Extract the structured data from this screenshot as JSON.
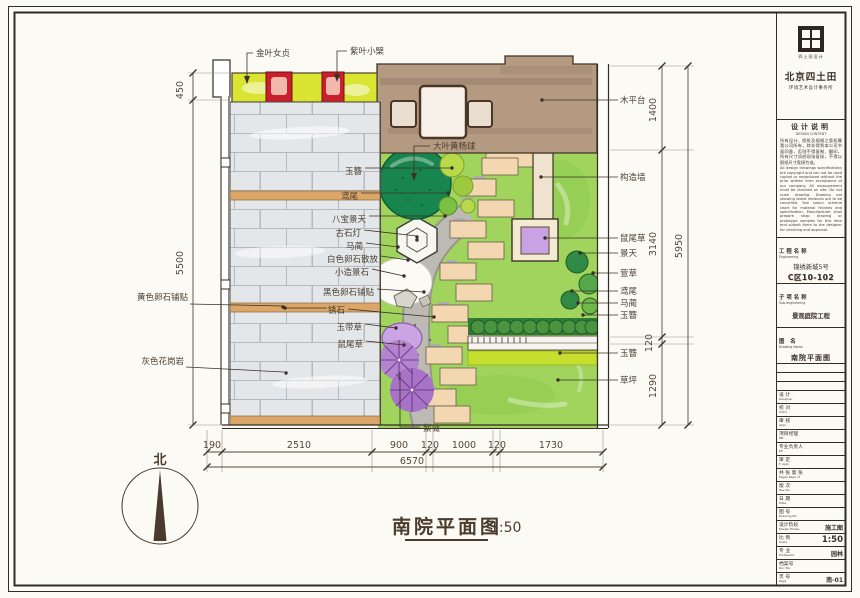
{
  "sheet": {
    "plan_title": "南院平面图",
    "plan_scale": "1:50",
    "north_label": "北"
  },
  "labels": {
    "top": [
      {
        "text": "金叶女贞"
      },
      {
        "text": "紫叶小檗"
      }
    ],
    "left_outer": [
      {
        "text": "黄色卵石铺贴"
      },
      {
        "text": "灰色花岗岩"
      }
    ],
    "left_inner": [
      {
        "text": "玉簪"
      },
      {
        "text": "鸢尾"
      },
      {
        "text": "八宝景天"
      },
      {
        "text": "古石灯"
      },
      {
        "text": "马蔺"
      },
      {
        "text": "白色卵石散放"
      },
      {
        "text": "小造景石"
      },
      {
        "text": "黑色卵石铺贴"
      },
      {
        "text": "锈石"
      },
      {
        "text": "玉带草"
      },
      {
        "text": "鼠尾草"
      }
    ],
    "center": [
      {
        "text": "大叶黄杨球"
      },
      {
        "text": "紫薇"
      }
    ],
    "right": [
      {
        "text": "木平台"
      },
      {
        "text": "构造墙"
      },
      {
        "text": "鼠尾草"
      },
      {
        "text": "景天"
      },
      {
        "text": "萱草"
      },
      {
        "text": "鸢尾"
      },
      {
        "text": "马蔺"
      },
      {
        "text": "玉簪"
      },
      {
        "text": "玉簪"
      },
      {
        "text": "草坪"
      }
    ]
  },
  "dimensions": {
    "left": [
      "450",
      "5500"
    ],
    "right_inner": [
      "1400",
      "3140",
      "120",
      "1290"
    ],
    "right_outer": [
      "5950"
    ],
    "bottom_segments": [
      "190",
      "2510",
      "900",
      "120",
      "1000",
      "120",
      "1730"
    ],
    "bottom_total": "6570"
  },
  "title_block": {
    "logo_text": "四土田设计",
    "company": "北京四土田",
    "company_sub": "环境艺术设计事务所",
    "notes_title": "设计说明",
    "notes_title_en": "DESIGN CONTENT",
    "notes_cn": "所有设计、图纸及规格之版权属我公司所有，除非得到本公司书面同意，否则不得复制、翻印。所有尺寸须经现场复核，不得以图纸尺寸直接为准。",
    "notes_en": "All design drawings specifications are copyright and can not be used copied or reproduced without the prior written form acceptance of our company. All measurement must be checked on site. Do not scale drawing. Drawing not showing latest revisions are to be cancelled. See colour scheme chart for material finishes and specification. Manufacturer shall prepare shop drawing or prototype samples for this item and submit them to the designer for checking and approval.",
    "project_section": {
      "label": "工程名称",
      "label_en": "Engineering",
      "name": "锦绣新城5号",
      "code": "C区10-102"
    },
    "sub_section": {
      "label": "子项名称",
      "label_en": "Sub-engineering",
      "name": "景观庭院工程"
    },
    "drawing_section": {
      "label": "图  名",
      "label_en": "Drawing Name",
      "name": "南院平面图"
    },
    "rows": [
      {
        "label": "设  计",
        "label_en": "Designer",
        "value": ""
      },
      {
        "label": "校  对",
        "label_en": "Chkd",
        "value": ""
      },
      {
        "label": "审  核",
        "label_en": "Appr",
        "value": ""
      },
      {
        "label": "项目经理",
        "label_en": "PM",
        "value": ""
      },
      {
        "label": "专业负责人",
        "label_en": "PP",
        "value": ""
      },
      {
        "label": "审  定",
        "label_en": "F. Appr",
        "value": ""
      },
      {
        "label": "共  张 第  张",
        "label_en": "Pages  Page of",
        "value": ""
      },
      {
        "label": "版  次",
        "label_en": "Rev No.",
        "value": ""
      },
      {
        "label": "日  期",
        "label_en": "Date",
        "value": ""
      },
      {
        "label": "图  号",
        "label_en": "Drawing No.",
        "value": ""
      },
      {
        "label": "设计阶段",
        "label_en": "Design Phase",
        "value": "施工图"
      },
      {
        "label": "比  例",
        "label_en": "Scale",
        "value": "1:50"
      },
      {
        "label": "专  业",
        "label_en": "Profession",
        "value": "园林"
      },
      {
        "label": "档案号",
        "label_en": "Doc No.",
        "value": ""
      },
      {
        "label": "页  号",
        "label_en": "Page",
        "value": "南-01"
      }
    ]
  },
  "colors": {
    "hedge_yellow_green": "#d9e531",
    "barberry_red": "#c8202c",
    "brick_gray": "#e4e7e9",
    "rust_stone_tan": "#dca668",
    "wood_deck": "#b49a80",
    "lawn_green": "#a0d45c",
    "boxwood_dark_green": "#19854e",
    "path_gray": "#bdbab4",
    "stepping_stone": "#f2d7b0",
    "crape_myrtle_purple": "#b584cf",
    "planter_purple": "#c9a2e4",
    "line_dark": "#332c24"
  }
}
